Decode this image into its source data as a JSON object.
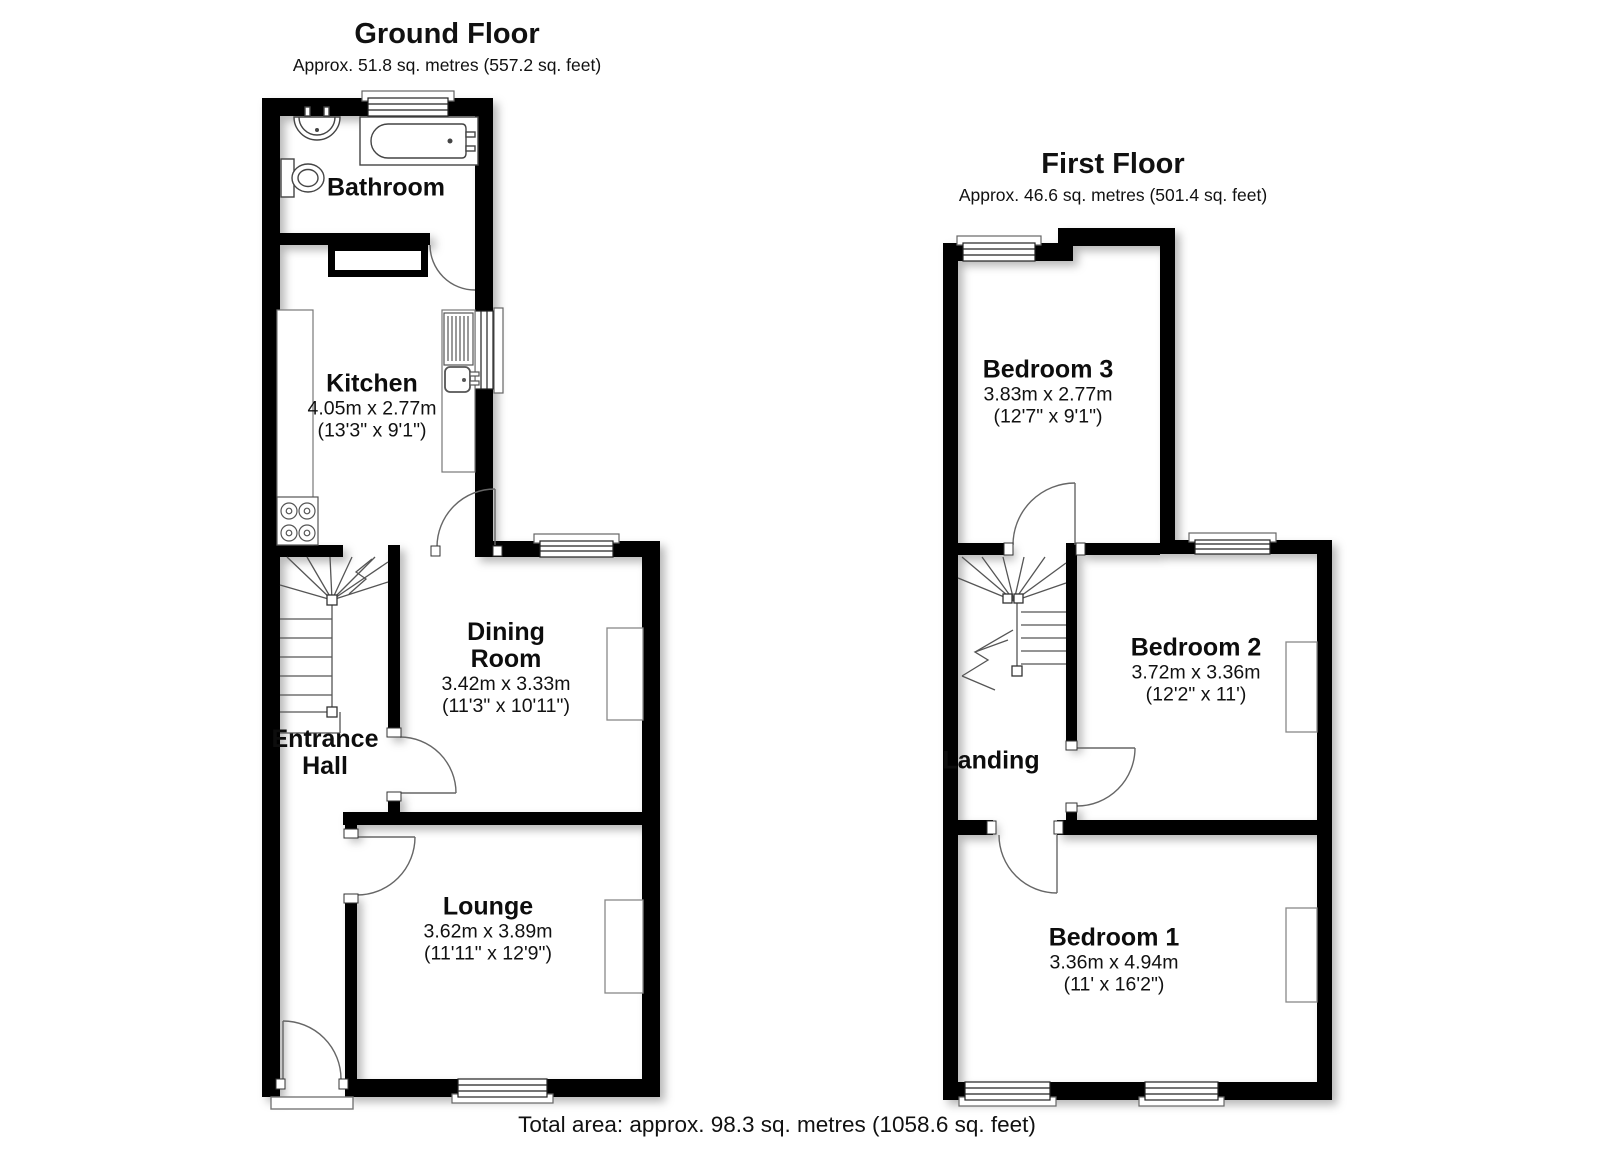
{
  "ground_floor": {
    "title": "Ground Floor",
    "subtitle": "Approx. 51.8 sq. metres (557.2 sq. feet)",
    "rooms": {
      "bathroom": {
        "name": "Bathroom"
      },
      "kitchen": {
        "name": "Kitchen",
        "metric": "4.05m x 2.77m",
        "imperial": "(13'3\" x 9'1\")"
      },
      "dining": {
        "name_line1": "Dining",
        "name_line2": "Room",
        "metric": "3.42m x 3.33m",
        "imperial": "(11'3\" x 10'11\")"
      },
      "hall": {
        "name_line1": "Entrance",
        "name_line2": "Hall"
      },
      "lounge": {
        "name": "Lounge",
        "metric": "3.62m x 3.89m",
        "imperial": "(11'11\" x 12'9\")"
      }
    }
  },
  "first_floor": {
    "title": "First Floor",
    "subtitle": "Approx. 46.6 sq. metres (501.4 sq. feet)",
    "rooms": {
      "bedroom3": {
        "name": "Bedroom 3",
        "metric": "3.83m x 2.77m",
        "imperial": "(12'7\" x 9'1\")"
      },
      "bedroom2": {
        "name": "Bedroom 2",
        "metric": "3.72m x 3.36m",
        "imperial": "(12'2\" x 11')"
      },
      "landing": {
        "name": "Landing"
      },
      "bedroom1": {
        "name": "Bedroom 1",
        "metric": "3.36m x 4.94m",
        "imperial": "(11' x 16'2\")"
      }
    }
  },
  "footer": {
    "total_area": "Total area: approx. 98.3 sq. metres (1058.6 sq. feet)"
  },
  "colors": {
    "wall": "#000000",
    "fixture_line": "#4d4d4d",
    "background": "#ffffff"
  }
}
